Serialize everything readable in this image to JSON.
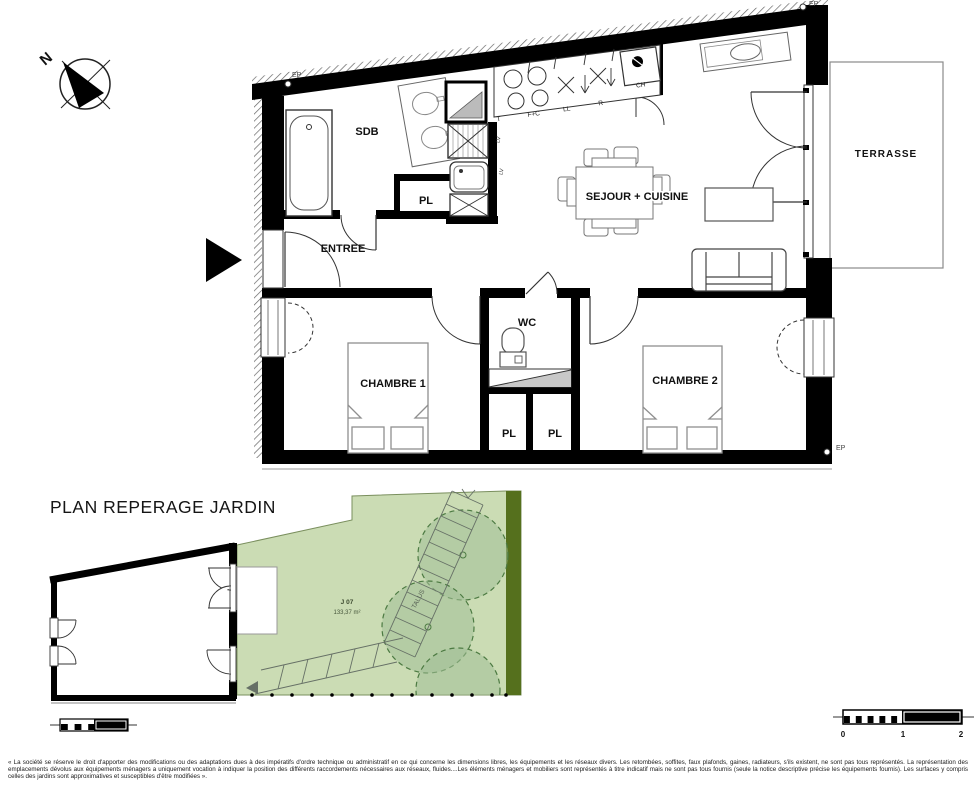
{
  "main_plan": {
    "rooms": {
      "sdb": "SDB",
      "pl_bath": "PL",
      "entree": "ENTREE",
      "sejour_cuisine": "SEJOUR + CUISINE",
      "terrasse": "TERRASSE",
      "wc": "WC",
      "chambre1": "CHAMBRE 1",
      "chambre2": "CHAMBRE 2",
      "pl_left": "PL",
      "pl_right": "PL"
    },
    "appliances": {
      "t": "T",
      "f_c": "F+C",
      "ll": "LL",
      "r": "R",
      "ch": "CH",
      "lv_upper": "LV",
      "lv_lower": "LV"
    },
    "markers": {
      "ep_top_left": "EP",
      "ep_top_right": "EP",
      "ep_bottom_right": "EP",
      "north": "N"
    }
  },
  "garden_plan": {
    "title": "PLAN REPERAGE JARDIN",
    "lot_id": "J 07",
    "lot_area": "133,37 m²",
    "slope_label": "TALUS"
  },
  "scale_bar": {
    "tick0": "0",
    "tick1": "1",
    "tick2": "2"
  },
  "disclaimer": "« La société se réserve le droit d'apporter des modifications ou des adaptations dues à des impératifs d'ordre technique ou administratif en ce qui concerne les dimensions libres, les équipements et les réseaux divers. Les retombées, soffites, faux plafonds, gaines, radiateurs, s'ils existent, ne sont pas tous représentés. La représentation des emplacements dévolus aux équipements ménagers a uniquement vocation à indiquer la position des différents raccordements nécessaires aux réseaux, fluides....Les éléments ménagers et mobiliers sont représentés à titre indicatif mais ne sont pas tous fournis (seule la notice descriptive précise les équipements fournis). Les surfaces y compris celles des jardins sont approximatives et susceptibles d'être modifiées ».",
  "colors": {
    "wall": "#000000",
    "garden_green": "#cbdcb4",
    "tree_green": "#a3bf97",
    "tree_outline": "#4c7a42",
    "hedge_dark": "#55701d"
  }
}
